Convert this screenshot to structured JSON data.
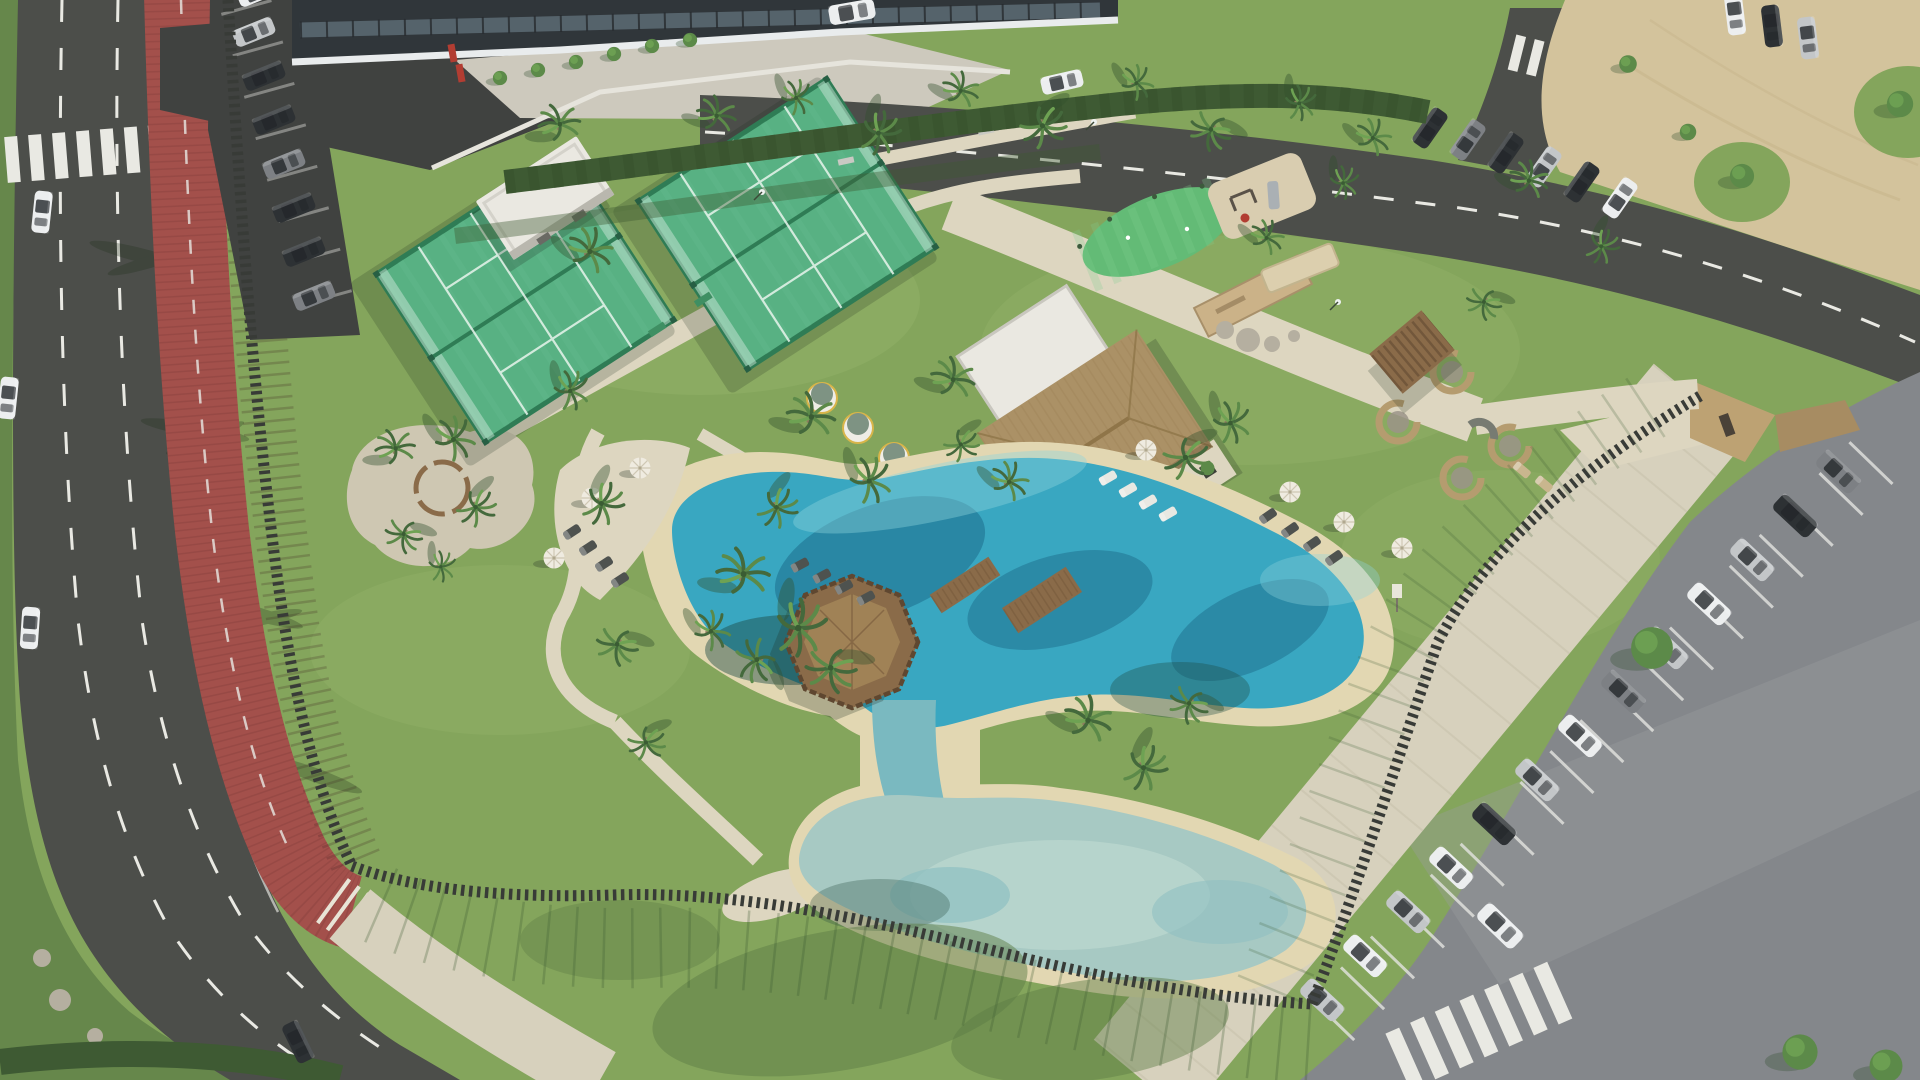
{
  "scene": {
    "description": "Aerial drone rendering of a tropical leisure park: four padel courts in two glass-fenced blocks, a thatched-roof club pavilion, a sandy lagoon pool and a shallow kids pool joined by a channel under an octagonal wooden deck, palm trees, lawns, a red bike lane along the west road, and parking lots with rows of cars to the east and north",
    "time_of_day": "sunny daytime, shadows falling to the lower-left",
    "inventory": {
      "padel_court_blocks": 2,
      "pools": [
        "lagoon-pool",
        "kids-pool"
      ],
      "wooden_deck": 1,
      "pavilion": 1,
      "east_row_parked_cars": 13,
      "northwest_parked_cars": 8,
      "north_road_parked_cars": 6,
      "corner_parked_cars": 3,
      "cars_on_roads": 8,
      "palm_trees": 41,
      "sun_umbrellas": 7,
      "sun_loungers": 18,
      "wicker_seating_pods": 4,
      "crosswalks": 3
    }
  },
  "palette": {
    "park_grass": "#84a55c",
    "grass_light": "#98b66d",
    "grass_shadow": "#5e7d45",
    "verge_green": "#66874b",
    "hedge_green": "#3e5a33",
    "road_asphalt": "#4c4e4a",
    "road_shadow": "#404240",
    "lane_marking": "#e9e9e3",
    "bike_lane": "#a3504b",
    "bike_lane_dark": "#7e3b39",
    "sand_lot": "#d3c39c",
    "sand_beach": "#e2d7b2",
    "path_beige": "#ddd6c0",
    "walkway_beige": "#d7d1bd",
    "parking_asphalt": "#84878b",
    "parking_light": "#9b9ea1",
    "pool_deep": "#1e6e8c",
    "pool_mid": "#39a7c1",
    "pool_light": "#8fd4dc",
    "kids_pool": "#a7c9c3",
    "water_channel": "#7ab9c0",
    "deck_wood": "#8a6b49",
    "deck_rail": "#5f4730",
    "court_green": "#58b183",
    "court_green_light": "#79caa0",
    "court_dark": "#2f7c55",
    "court_line": "#e8f4ec",
    "fence_dark": "#383b37",
    "building_white": "#eae8e1",
    "building_shadow": "#c9c7bf",
    "facade_dark": "#30363a",
    "roof_white": "#e9eced",
    "glass_blue": "#5c6b74",
    "thatch": "#ab9166",
    "thatch_dark": "#8f7549",
    "umbrella_white": "#efebe0",
    "wicker": "#b59c6f",
    "red_accent": "#b23d32",
    "olive_green": "#7e9383",
    "palm_dark": "#44693c",
    "palm_mid": "#5c8a49",
    "palm_light": "#6ea253",
    "trunk_brown": "#8d7c5e",
    "gravel": "#cec7b2",
    "rock_gray": "#b5afa0",
    "car_white": "#eceeef",
    "car_silver": "#c3c6c8",
    "car_gray": "#7d8084",
    "car_dark": "#2d3134"
  }
}
